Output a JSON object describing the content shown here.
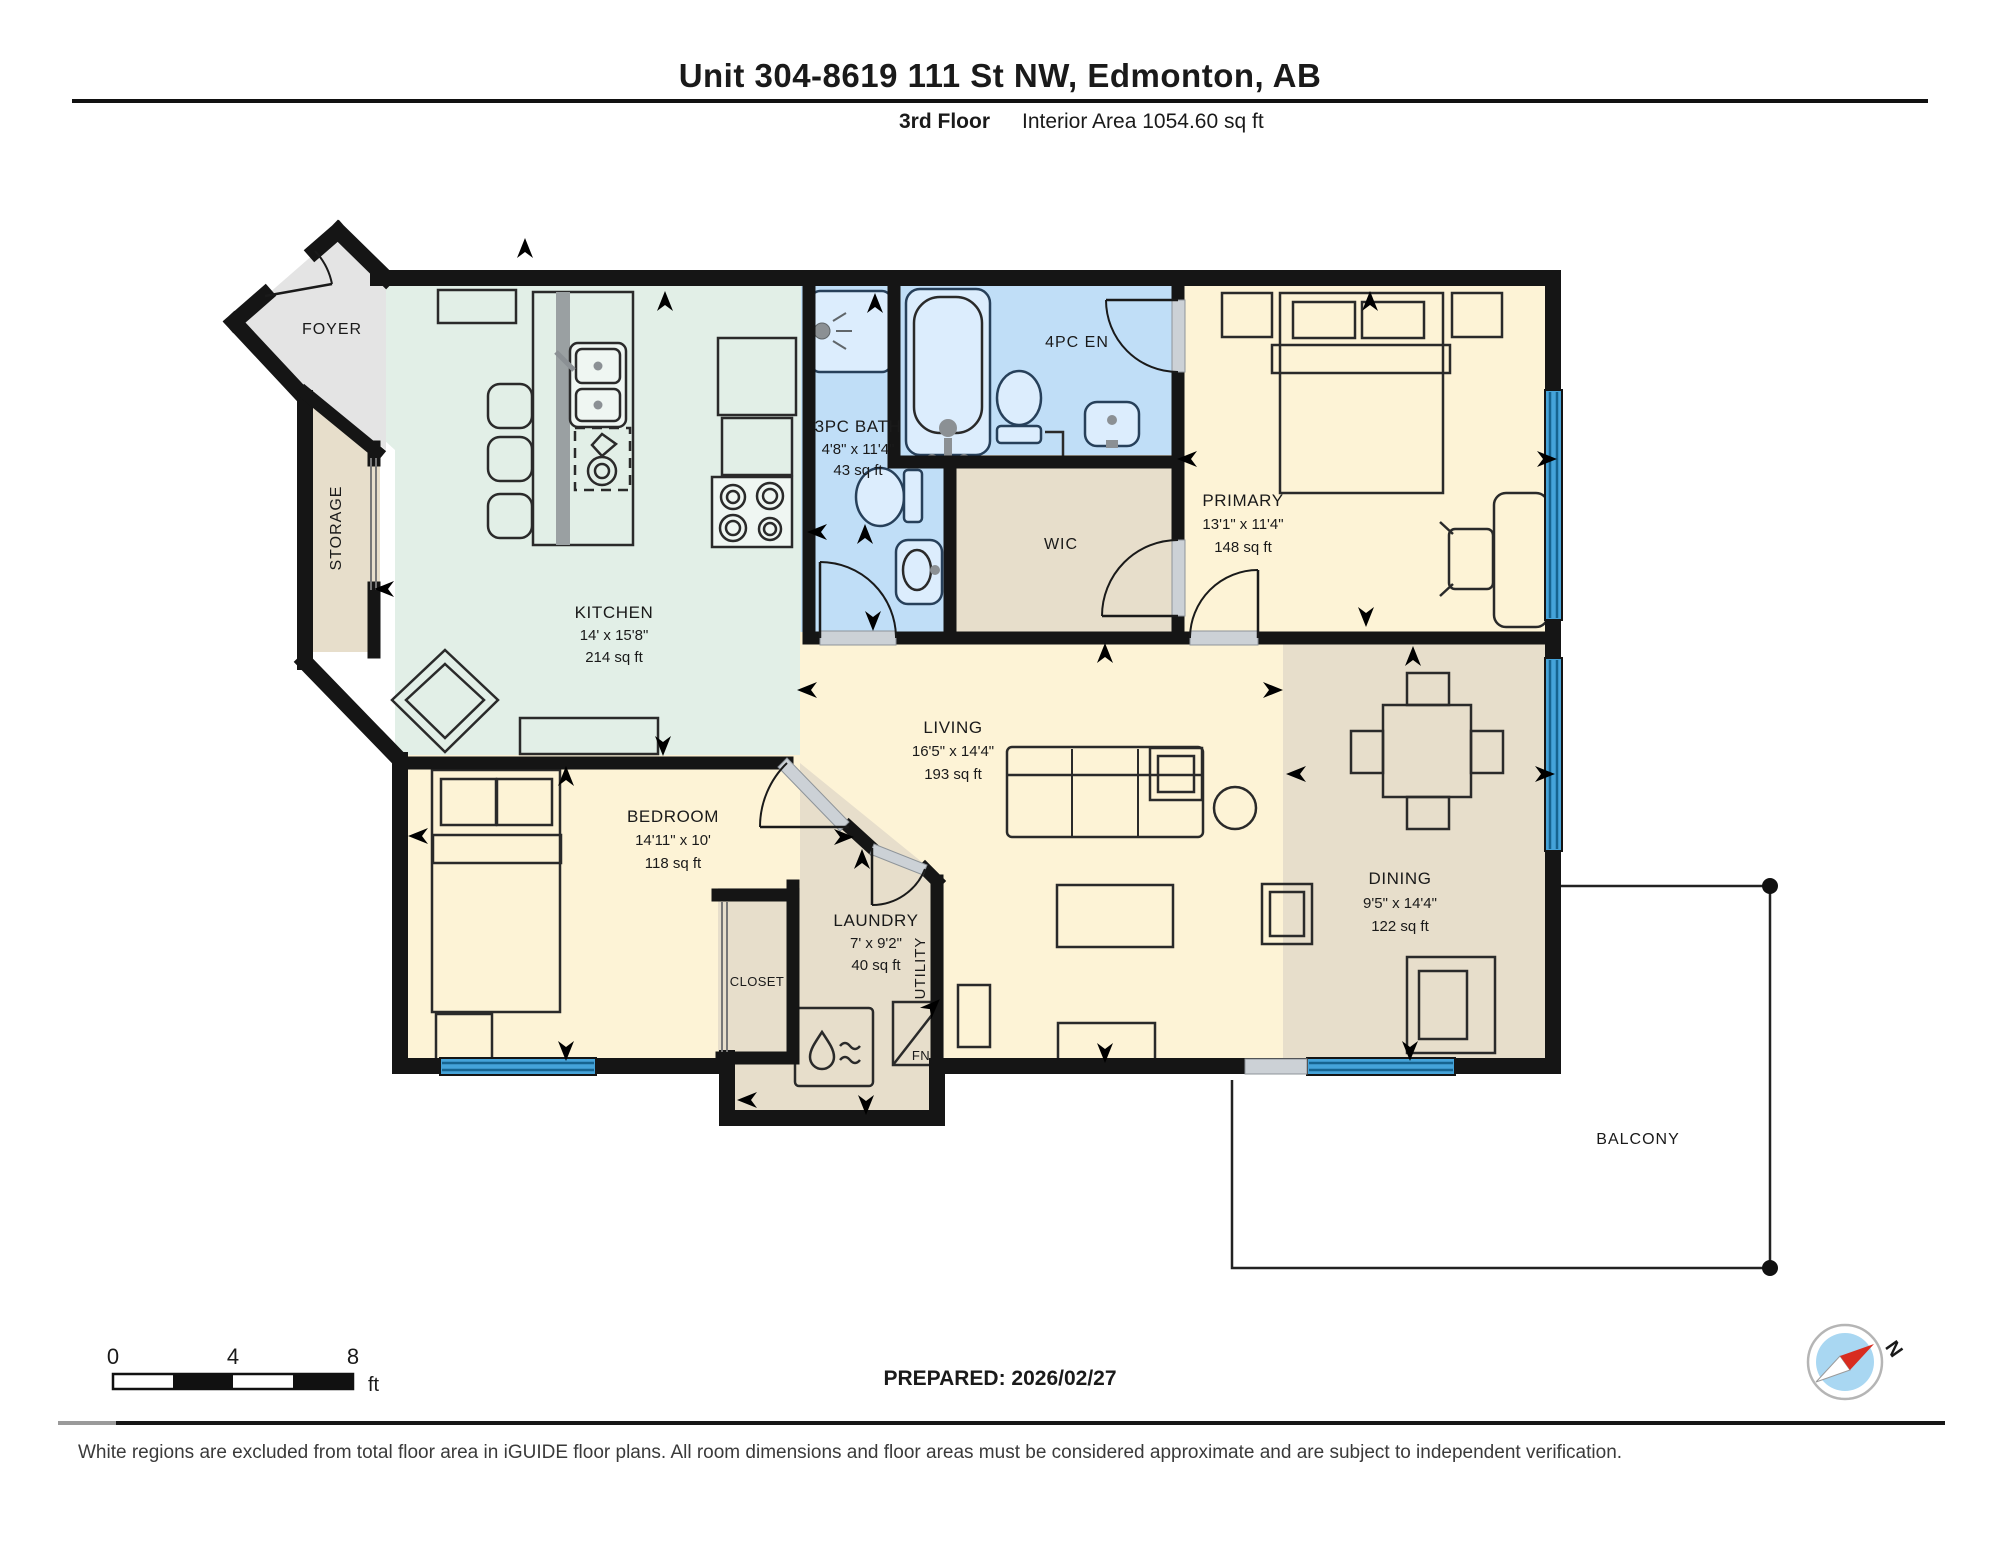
{
  "page": {
    "title": "Unit 304-8619 111 St NW, Edmonton, AB",
    "floor": "3rd Floor",
    "interior_area": "Interior Area 1054.60 sq ft"
  },
  "rooms": {
    "foyer": {
      "name": "FOYER"
    },
    "storage": {
      "name": "STORAGE"
    },
    "kitchen": {
      "name": "KITCHEN",
      "dim": "14' x 15'8\"",
      "area": "214 sq ft"
    },
    "bath3pc": {
      "name": "3PC BATH",
      "dim": "4'8\" x 11'4\"",
      "area": "43 sq ft"
    },
    "ensuite": {
      "name": "4PC EN"
    },
    "wic": {
      "name": "WIC"
    },
    "primary": {
      "name": "PRIMARY",
      "dim": "13'1\" x 11'4\"",
      "area": "148 sq ft"
    },
    "living": {
      "name": "LIVING",
      "dim": "16'5\" x 14'4\"",
      "area": "193 sq ft"
    },
    "dining": {
      "name": "DINING",
      "dim": "9'5\" x 14'4\"",
      "area": "122 sq ft"
    },
    "bedroom": {
      "name": "BEDROOM",
      "dim": "14'11\" x 10'",
      "area": "118 sq ft"
    },
    "closet": {
      "name": "CLOSET"
    },
    "laundry": {
      "name": "LAUNDRY",
      "dim": "7' x 9'2\"",
      "area": "40 sq ft"
    },
    "utility": {
      "name": "UTILITY"
    },
    "furnace": {
      "name": "FN"
    },
    "balcony": {
      "name": "BALCONY"
    }
  },
  "scale_bar": {
    "t0": "0",
    "t4": "4",
    "t8": "8",
    "unit": "ft"
  },
  "compass": {
    "north": "N"
  },
  "footer": {
    "prepared": "PREPARED: 2026/02/27",
    "disclaimer": "White regions are excluded from total floor area in iGUIDE floor plans. All room dimensions and floor areas must be considered approximate and are subject to independent verification."
  },
  "colors": {
    "wall": "#151515",
    "window_blue": "#45a3d9",
    "bath_fill": "#c0def7",
    "kitchen_fill": "#e2efe7",
    "warm_room_fill": "#fdf3d6",
    "tan_fill": "#e7decb",
    "foyer_fill": "#e4e4e4",
    "compass_red": "#d82c20"
  }
}
